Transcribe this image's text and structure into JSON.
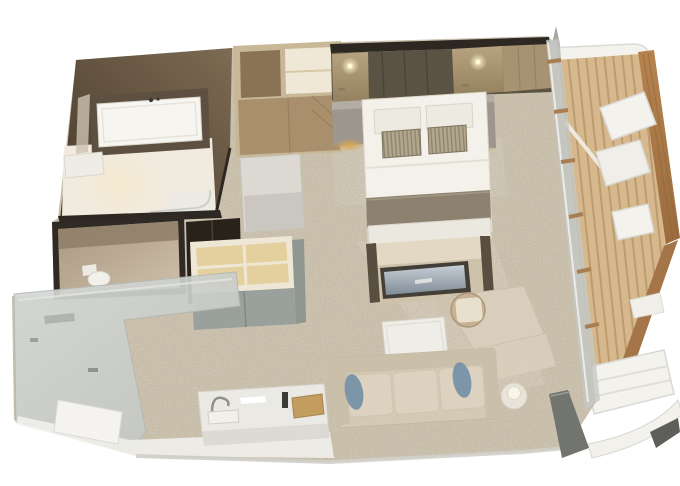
{
  "scene": {
    "type": "3d-floor-plan",
    "description": "Axonometric 3D rendering of a ship suite floor plan: bathroom with tub, separate water closet, wardrobes, bedroom with double bed, TV console, desk, living area with sofa, entry hall with wet bar, and a private wood-deck balcony with lounge furniture",
    "rooms": [
      {
        "name": "bathroom",
        "features": [
          "bathtub",
          "vanity",
          "shower",
          "mirror"
        ]
      },
      {
        "name": "water-closet",
        "features": [
          "toilet"
        ]
      },
      {
        "name": "wardrobe-area",
        "features": [
          "open-shelves",
          "cabinets",
          "dresser",
          "dark-closet"
        ]
      },
      {
        "name": "bedroom",
        "features": [
          "double-bed",
          "pillows",
          "striped-cushions",
          "throw-blanket",
          "bench",
          "nightstands",
          "wall-sconces",
          "headboard-wall"
        ]
      },
      {
        "name": "media-wall",
        "features": [
          "tv-console",
          "tv-screen"
        ]
      },
      {
        "name": "work-area",
        "features": [
          "stone-desk",
          "barrel-chair"
        ]
      },
      {
        "name": "living-area",
        "features": [
          "sofa",
          "blue-accent-pillows",
          "coffee-table",
          "side-table",
          "table-lamp"
        ]
      },
      {
        "name": "entry-hall",
        "features": [
          "entry-door",
          "wet-bar",
          "sink",
          "faucet",
          "serving-board",
          "bottle"
        ]
      },
      {
        "name": "balcony",
        "features": [
          "wood-slat-deck",
          "lounge-chairs",
          "chaise",
          "side-table",
          "divider-pole",
          "curved-railing",
          "open-glass-door",
          "canopy"
        ]
      }
    ]
  },
  "colors": {
    "background": "#ffffff",
    "carpet": "#cdc3af",
    "stone_floor": "#dacfbc",
    "wall_dark": "#2d2822",
    "bathroom_wall_dark": "#46392c",
    "bathroom_wall_light": "#7d6b52",
    "bathroom_floor": "#f1ebdf",
    "tub_deck": "#5d5040",
    "tub_white": "#f7f5f0",
    "wc_frame": "#2f2a24",
    "wc_wall_dark": "#a89680",
    "wc_wall_light": "#cfc1ab",
    "toilet_white": "#f2f0ea",
    "wardrobe_frame": "#c8b897",
    "wardrobe_interior": "#8a7355",
    "wardrobe_interior_light": "#f0e8d6",
    "wardrobe_door": "#a98f6b",
    "dresser_white": "#dcd9d2",
    "dark_cabinet": "#29221b",
    "shelf_frame": "#eee7d6",
    "shelf_wood": "#e4cf9f",
    "closet_door_gray": "#9aa09b",
    "closet_side_gray": "#8f958f",
    "headboard_panel": "#5a5243",
    "headboard_side_light": "#b7a37f",
    "headboard_side_dark": "#94815f",
    "wall_tan": "#a79272",
    "sconce_glow": "#fff3cf",
    "nightstand": "#9d968e",
    "nightstand_base_gold": "#d9a74f",
    "bed_linen": "#f3f1ea",
    "pillow_white": "#edeae1",
    "cushion_base": "#b2a68d",
    "cushion_stripe": "#8f8570",
    "bed_throw": "#8d8270",
    "bench_white": "#ebe8e0",
    "console_top": "#e3d8c3",
    "console_front": "#cfc2aa",
    "console_post": "#584f41",
    "tv_frame": "#433f38",
    "tv_sky": "#c6cfd5",
    "tv_sea": "#7f8b97",
    "desk_stone": "#d8cebb",
    "chair_tan": "#c6b293",
    "chair_seat": "#e8dfcc",
    "sofa_base": "#d4c9b5",
    "sofa_back": "#cabfa9",
    "sofa_cushion": "#dcd2bf",
    "pillow_blue": "#7d95a9",
    "coffee_table": "#efede7",
    "side_table": "#e8e4d9",
    "lamp_shade": "#f8f5eb",
    "entry_wall_light": "#d6d9d5",
    "entry_wall_dark": "#c0c4c0",
    "door_white": "#f4f3ef",
    "floor_white": "#f0efeb",
    "bar_counter": "#ebe9e4",
    "faucet_gray": "#8f8f8b",
    "wood_board": "#c39d60",
    "bottle_dark": "#3a3a37",
    "glass_wall": "#c4c8c4",
    "mullion_wood": "#a97f52",
    "door_glass_dark": "#72746f",
    "deck_wood": "#d6b88c",
    "deck_slat": "#bb9c70",
    "balcony_wall_top": "#b5834e",
    "balcony_wall_bottom": "#9a6c3f",
    "balcony_wall_lower": "#a5754a",
    "balcony_white": "#f3f2ed",
    "balcony_shadow": "#d9d8d1",
    "divider_pole": "#a6a6a2",
    "railing_white": "#f2f1ec",
    "dark_wedge": "#5e5e5a"
  }
}
